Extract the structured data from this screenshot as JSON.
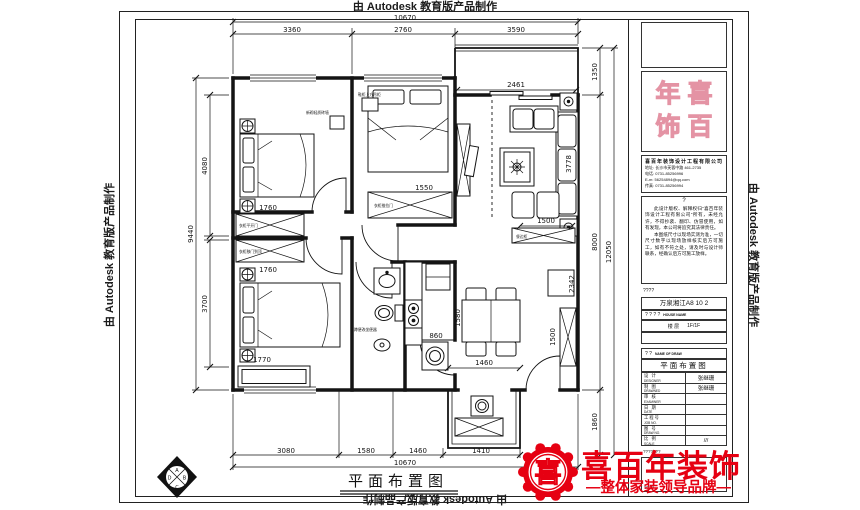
{
  "watermark": "由 Autodesk 教育版产品制作",
  "plan": {
    "title": "平面布置图",
    "dims": {
      "top_total": "10670",
      "top1": "3360",
      "top2": "2760",
      "top3": "3590",
      "bottom1": "3080",
      "bottom2": "1580",
      "bottom3": "1460",
      "bottom4": "1410",
      "bottom_total": "10670",
      "left1": "4080",
      "left2": "9440",
      "left3": "3700",
      "right1": "1350",
      "right2": "8000",
      "right3": "12050",
      "right4": "1860",
      "opening": "2461",
      "sofa": "3778",
      "sofa_front": "1500",
      "tl_wardrobe": "1760",
      "bl_wardrobe": "1760",
      "bl_cabinet": "1770",
      "mid_wardrobe": "1550",
      "kitchen": "860",
      "kitchen_depth": "1580",
      "hall_side": "2342",
      "shoe_cabinet": "1500",
      "balcony": "1460"
    },
    "notes": {
      "n1": "鞋柜上方吊柜",
      "n2": "新砌轻质砖墙",
      "n3": "衣柜平开门",
      "n4": "衣柜移门到顶",
      "n5": "衣柜推拉门",
      "n6": "蹲便改坐便器",
      "n7": "餐边柜"
    },
    "compass": {
      "a": "A",
      "b": "B",
      "c": "C",
      "d": "D"
    }
  },
  "titleblock": {
    "seal": {
      "tl": "年",
      "tr": "喜",
      "bl": "饰",
      "br": "百"
    },
    "company": {
      "name": "喜百年装饰设计工程有限公司",
      "line1": "地址: 长沙市芙蓉中路 461-2735",
      "line2": "电话: 0731-85256996",
      "line3": "E-m: 56254894@qq.com",
      "line4": "传真: 0731-85256994"
    },
    "disclaimer": {
      "mark": "?",
      "p1": "此设计版权、解释权归“喜百年装饰设计工程有限公司”所有，未经允许，不得抄袭、翻印、仿冒使用，如有发现，本公司将追究其法律责任。",
      "p2": "本图纸尺寸以现场实测为准，一切尺寸数字以现场放样核实后方可施工，如有不符之处，请及时与设计师联系，经确认后方可施工放样。"
    },
    "rows": {
      "q1": "????",
      "project": "万泉湘江A8 10 2",
      "house_q": "? ? ? ?",
      "house_en": "HOUSE NAME",
      "area_label": "楼 层",
      "area_value": "1F/1F",
      "name_q": "? ?",
      "name_en": "NAME OF DRAW",
      "drawing": "平面布置图",
      "q2": "???????",
      "q3": "????"
    },
    "table": [
      {
        "cn": "设 计",
        "en": "DESIGNER",
        "val": "张继珊"
      },
      {
        "cn": "制 图",
        "en": "DRAWNED",
        "val": "张继珊"
      },
      {
        "cn": "审 核",
        "en": "EXAMINER",
        "val": ""
      },
      {
        "cn": "日 期",
        "en": "DATE",
        "val": ""
      },
      {
        "cn": "工程号",
        "en": "JOB NO.",
        "val": ""
      },
      {
        "cn": "图 号",
        "en": "DRAW NO.",
        "val": ""
      },
      {
        "cn": "比 例",
        "en": "SCALE",
        "val": "///"
      }
    ]
  },
  "logo": {
    "emblem": "喜",
    "name": "喜百年装饰",
    "slogan": "—整体家装领导品牌—"
  }
}
